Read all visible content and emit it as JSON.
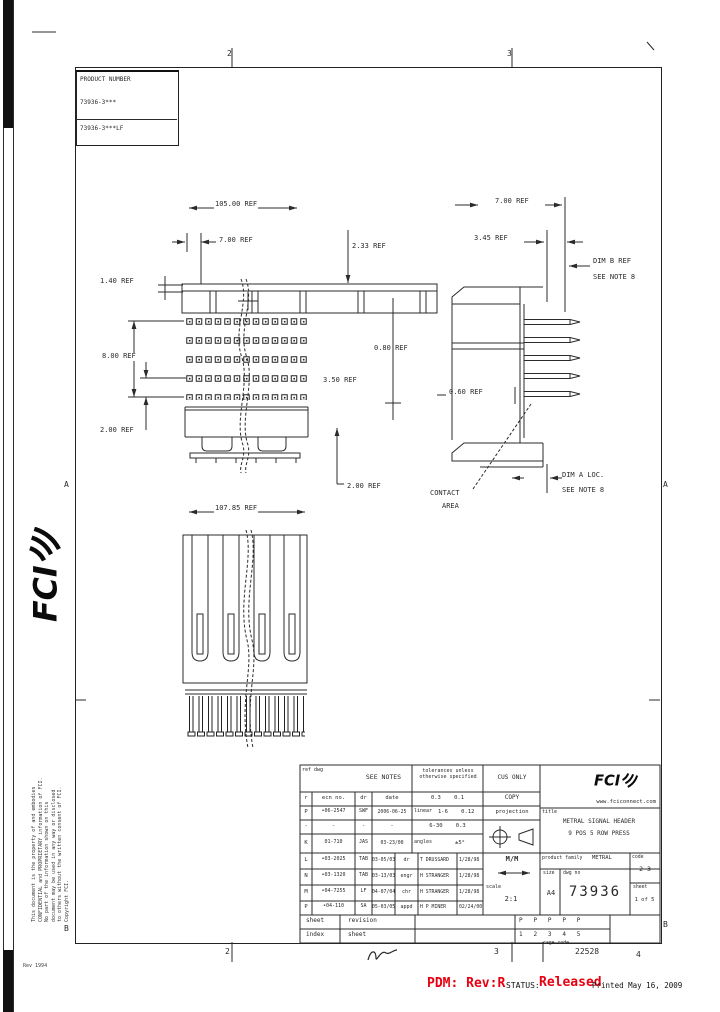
{
  "document": {
    "logo_text": "FCI",
    "website": "www.fciconnect.com",
    "product_table": {
      "header": "PRODUCT NUMBER",
      "row1": "73936-3***",
      "row2": "73936-3***LF"
    },
    "zones": {
      "top1": "2",
      "top2": "3",
      "bottom1": "2",
      "bottom2": "3",
      "bottom3": "4",
      "left_a": "A",
      "left_b": "B",
      "right_a": "A",
      "right_b": "B"
    },
    "cage": {
      "label": "cage code",
      "value": "22528"
    },
    "footer": {
      "pdm": "PDM: Rev:R",
      "status_label": "STATUS:",
      "status_value": "Released",
      "printed": "Printed May 16, 2009"
    },
    "form_note": "Rev 1994",
    "accent_red": "#e80011",
    "confidential": [
      "This document is the property of and embodies",
      "CONFIDENTIAL and PROPRIETARY information of FCI.",
      "No part of the information shown on this",
      "document may be used in any way or disclosed",
      "to others without the written consent of FCI.",
      "Copyright FCI."
    ]
  },
  "views": {
    "front": {
      "overall": "105.00 REF",
      "col_pitch": "7.00 REF",
      "top_h": "1.40 REF",
      "row_span": "8.00 REF",
      "row_pitch": "2.00 REF",
      "right_a": "2.33 REF",
      "right_b": "0.80 REF",
      "right_c": "3.50 REF",
      "bottom_p": "2.00 REF"
    },
    "side": {
      "width": "7.00 REF",
      "offset": "3.45 REF",
      "dim_b": "DIM B REF",
      "dim_b_note": "SEE NOTE 8",
      "pin_w": "0.60 REF",
      "contact_l1": "CONTACT",
      "contact_l2": "AREA",
      "dim_a": "DIM A LOC.",
      "dim_a_note": "SEE NOTE 8"
    },
    "bottom": {
      "overall": "107.85 REF"
    }
  },
  "title_block": {
    "ref_label": "ref dwg",
    "see_notes": "SEE NOTES",
    "tol_header": "tolerances unless otherwise specified",
    "cus": "CUS ONLY",
    "copy": "COPY",
    "projection_label": "projection",
    "rev_header": {
      "r": "r",
      "ecn": "ecn no.",
      "dr": "dr",
      "date": "date"
    },
    "revisions": [
      {
        "r": "P",
        "ecn": "•06-2547",
        "dr": "SWF",
        "date": "2006-06-25"
      },
      {
        "r": "-",
        "ecn": "-",
        "dr": "-",
        "date": "-"
      },
      {
        "r": "K",
        "ecn": "01-710",
        "dr": "JAS",
        "date": "03-23/00"
      },
      {
        "r": "L",
        "ecn": "•03-2025",
        "dr": "TAB",
        "date": "03-05/03"
      },
      {
        "r": "N",
        "ecn": "•03-1320",
        "dr": "TAB",
        "date": "03-13/03"
      },
      {
        "r": "M",
        "ecn": "•04-7255",
        "dr": "LF",
        "date": "04-07/04"
      },
      {
        "r": "P",
        "ecn": "•04-110",
        "dr": "SA",
        "date": "05-03/05"
      }
    ],
    "tol": {
      "row1": "0.3    0.1",
      "linear_label": "linear",
      "row2": "1-6    0.12",
      "row3": "6-30    0.3",
      "angles_label": "angles",
      "angles": "±5°"
    },
    "approvals": [
      {
        "role": "dr",
        "name": "T DRUSSARD",
        "date": "1/28/98"
      },
      {
        "role": "engr",
        "name": "H STRANGER",
        "date": "1/28/98"
      },
      {
        "role": "chr",
        "name": "H STRANGER",
        "date": "1/28/98"
      },
      {
        "role": "appd",
        "name": "H P MINER",
        "date": "02/24/00"
      }
    ],
    "units": "M/M",
    "scale_label": "scale",
    "scale": "2:1",
    "title_label": "title",
    "title1": "METRAL SIGNAL HEADER",
    "title2": "9 POS 5 ROW PRESS",
    "family_label": "product family",
    "family": "METRAL",
    "size_label": "size",
    "size": "A4",
    "dwg_label": "dwg no",
    "dwg_no": "73936",
    "code_label": "code",
    "code": "2 3",
    "sheet_label": "sheet",
    "sheet": "1 of 5",
    "sheet_index": {
      "l1": "sheet",
      "l2": "index",
      "r1": "revision",
      "r2": "sheet",
      "revisions": "P   P   P   P   P",
      "sheets": "1   2   3   4   5"
    }
  }
}
